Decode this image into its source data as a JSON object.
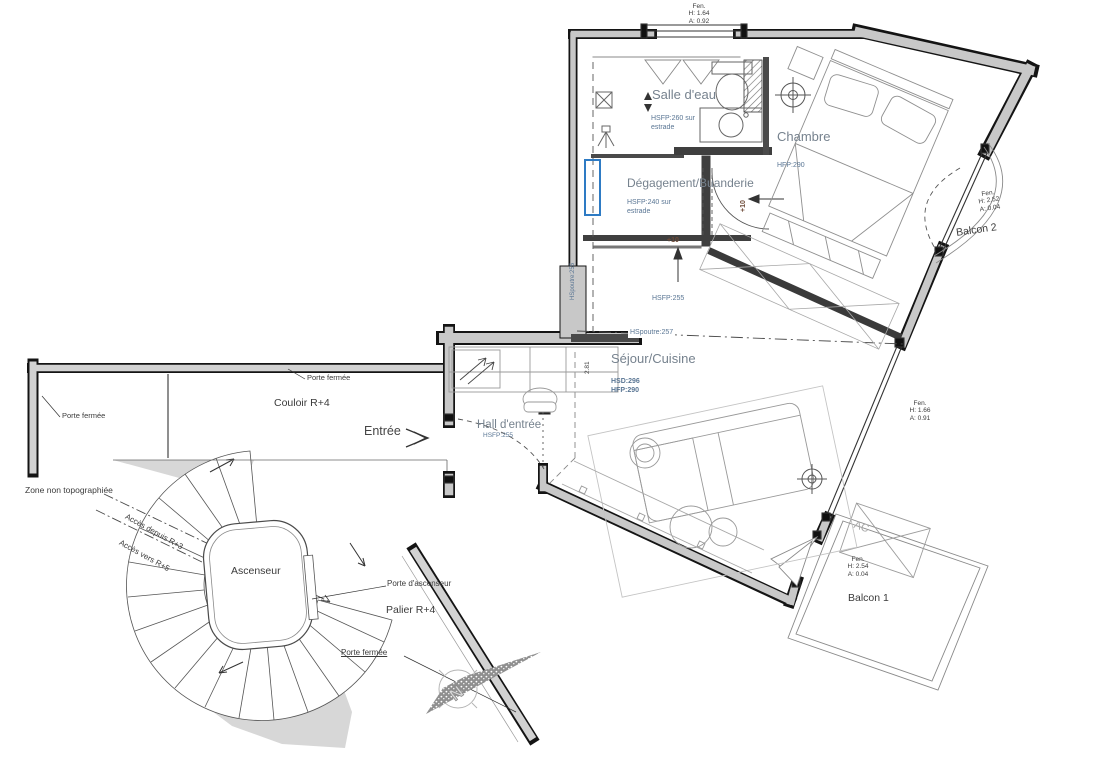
{
  "plan": {
    "rooms": {
      "salle_deau": {
        "name": "Salle d'eau",
        "note1": "HSFP:260 sur",
        "note2": "estrade"
      },
      "chambre": {
        "name": "Chambre",
        "note1": "HFP:290"
      },
      "degagement": {
        "name": "Dégagement/Buanderie",
        "note1": "HSFP:240 sur",
        "note2": "estrade"
      },
      "sejour": {
        "name": "Séjour/Cuisine",
        "note1": "HSD:296",
        "note2": "HFP:290"
      },
      "hall": {
        "name": "Hall d'entrée",
        "note1": "HSFP:255"
      },
      "couloir": {
        "name": "Couloir R+4"
      },
      "palier": {
        "name": "Palier R+4"
      },
      "ascenseur": {
        "name": "Ascenseur"
      },
      "balcon1": {
        "name": "Balcon 1"
      },
      "balcon2": {
        "name": "Balcon 2"
      }
    },
    "windows": {
      "top": {
        "l1": "Fen.",
        "l2": "H: 1.64",
        "l3": "A: 0.92"
      },
      "balcon2": {
        "l1": "Fen.",
        "l2": "H: 2.52",
        "l3": "A: 0.04"
      },
      "sejour": {
        "l1": "Fen.",
        "l2": "H: 1.66",
        "l3": "A: 0.91"
      },
      "balcon1": {
        "l1": "Fen.",
        "l2": "H: 2.54",
        "l3": "A: 0.04"
      }
    },
    "annotations": {
      "hsfp_255": "HSFP:255",
      "hspoutre_257": "HSpoutre:257",
      "hspoutre_vert": "HSpoutre:255",
      "dim_281": "2.81",
      "level_a": "+10",
      "level_b": "+10",
      "ac": "AC",
      "zone": "Zone non topographiée",
      "acces_depuis": "Accès depuis R+3",
      "acces_vers": "Accès vers R+5",
      "porte_fermee_corridor": "Porte fermée",
      "porte_fermee_left": "Porte fermée",
      "porte_fermee_palier": "Porte fermée",
      "porte_ascenseur": "Porte d'ascenseur",
      "entree": "Entrée",
      "north": "N"
    },
    "colors": {
      "wall_fill": "#c8c8c8",
      "annotation_blue": "#5a7694",
      "room_label_gray": "#76828e",
      "highlight_blue": "#2e7bc4",
      "level_brown": "#6e4a38"
    }
  }
}
